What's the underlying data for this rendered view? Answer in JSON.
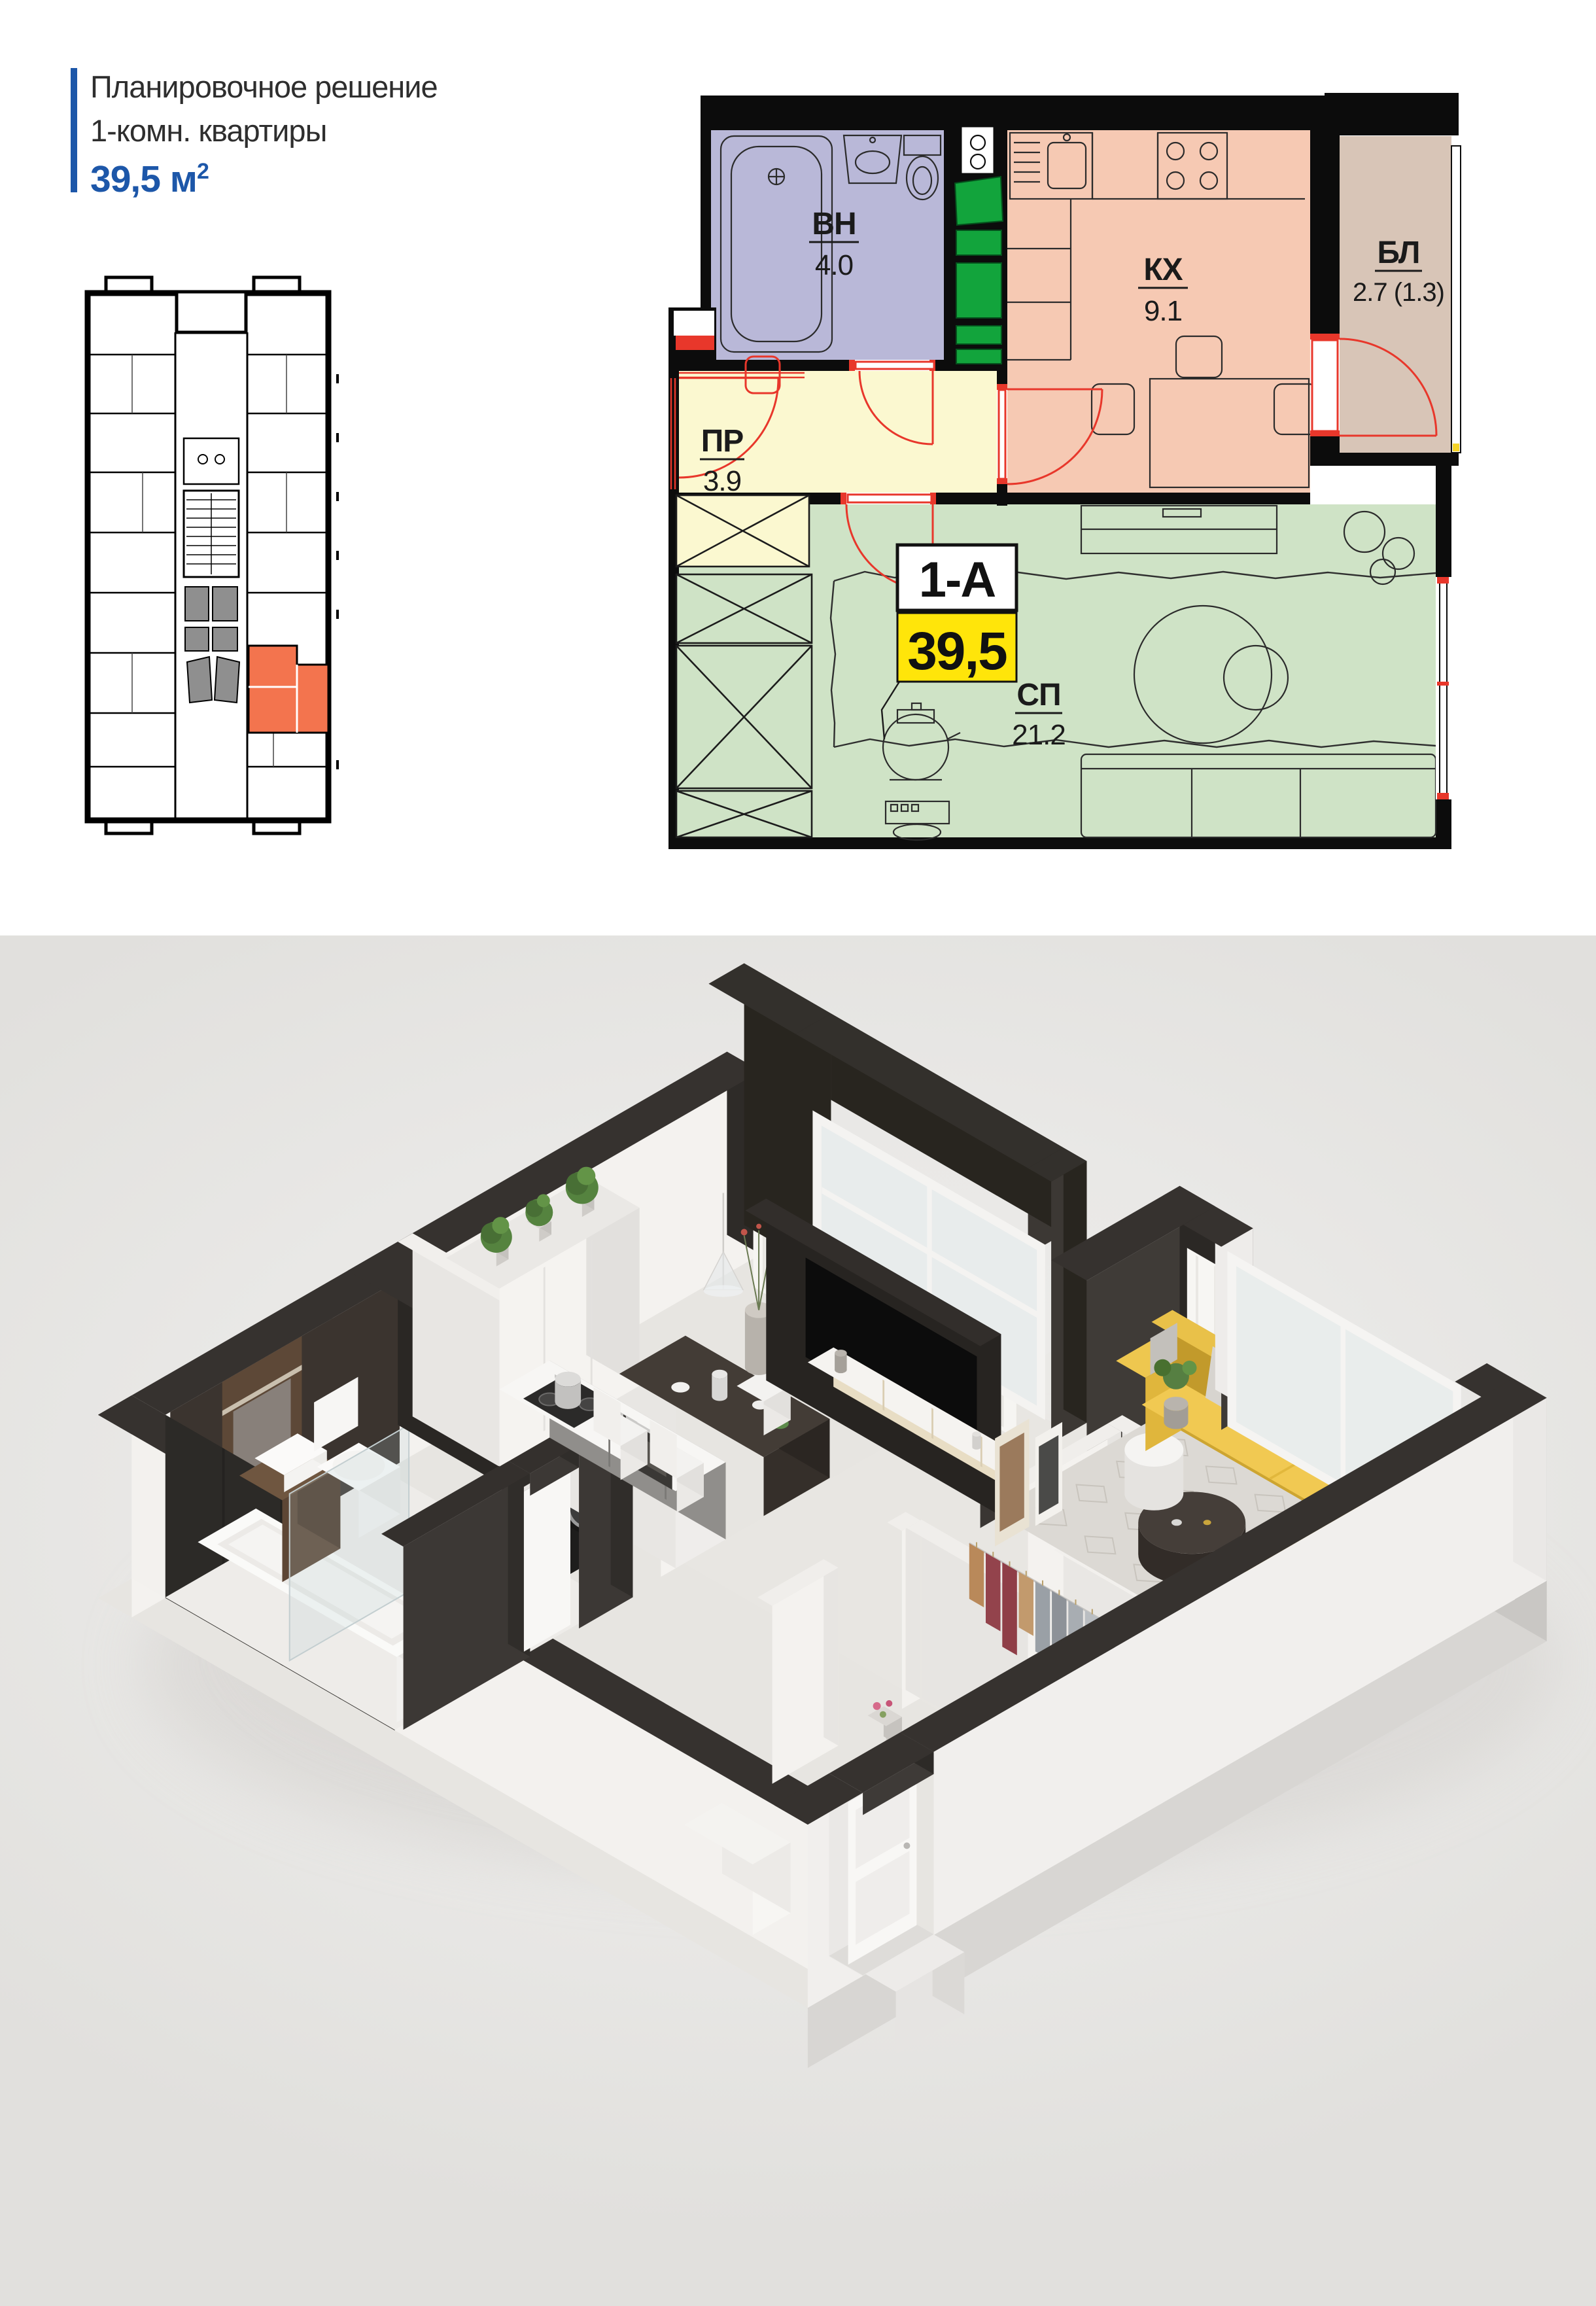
{
  "header": {
    "title_line1": "Планировочное решение",
    "title_line2": "1-комн. квартиры",
    "area_value": "39,5 м",
    "area_sup": "2"
  },
  "plan": {
    "unit_label": "1-А",
    "unit_area": "39,5",
    "rooms": [
      {
        "key": "bathroom",
        "label": "ВН",
        "area": "4.0"
      },
      {
        "key": "kitchen",
        "label": "КХ",
        "area": "9.1"
      },
      {
        "key": "balcony",
        "label": "БЛ",
        "area": "2.7 (1.3)"
      },
      {
        "key": "hallway",
        "label": "ПР",
        "area": "3.9"
      },
      {
        "key": "living",
        "label": "СП",
        "area": "21.2"
      }
    ]
  },
  "colors": {
    "accent_blue": "#1d57a9",
    "unit_orange": "#f3744e",
    "bathroom": "#b9b8d8",
    "kitchen": "#f6c9b3",
    "balcony": "#d8c5b7",
    "hallway": "#fbf8d0",
    "living": "#cfe3c6",
    "shaft_green": "#12a43c",
    "plan_red": "#e8372b",
    "badge_yellow": "#ffe50a"
  }
}
